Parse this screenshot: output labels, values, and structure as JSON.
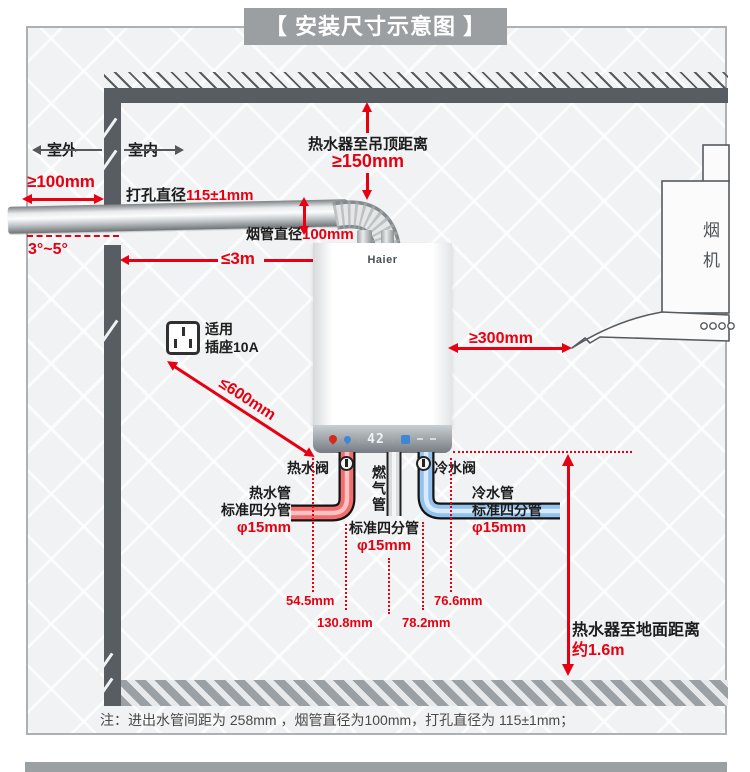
{
  "title": "【 安装尺寸示意图 】",
  "colors": {
    "accent_red": "#e60012",
    "wall_gray": "#575d62",
    "banner_gray": "#9b9fa2",
    "hot_pipe": "#f26d6d",
    "cold_pipe": "#92c2ee",
    "gas_pipe": "#d9dbdc"
  },
  "diagram": {
    "outdoor": "室外",
    "indoor": "室内",
    "wall_clearance": "≥100mm",
    "hole_label": "打孔直径",
    "hole_value": "115±1mm",
    "slope": "3°~5°",
    "flue_dia_label": "烟管直径",
    "flue_dia_value": "100mm",
    "flue_length": "≤3m",
    "ceiling_label": "热水器至吊顶距离",
    "ceiling_value": "≥150mm",
    "brand": "Haier",
    "display_temp": "42",
    "socket_label_1": "适用",
    "socket_label_2": "插座10A",
    "socket_distance": "≤600mm",
    "hood_label": "烟机",
    "hood_distance": "≥300mm",
    "hot_valve": "热水阀",
    "gas_pipe_label": "燃气管",
    "cold_valve": "冷水阀",
    "hot_pipe": {
      "l1": "热水管",
      "l2": "标准四分管",
      "l3": "φ15mm"
    },
    "gas_pipe": {
      "l1": "标准四分管",
      "l2": "φ15mm"
    },
    "cold_pipe": {
      "l1": "冷水管",
      "l2": "标准四分管",
      "l3": "φ15mm"
    },
    "spacings": [
      "54.5mm",
      "130.8mm",
      "78.2mm",
      "76.6mm"
    ],
    "floor_label": "热水器至地面距离",
    "floor_value": "约1.6m"
  },
  "note": "注：进出水管间距为 258mm ，烟管直径为100mm，打孔直径为 115±1mm；"
}
